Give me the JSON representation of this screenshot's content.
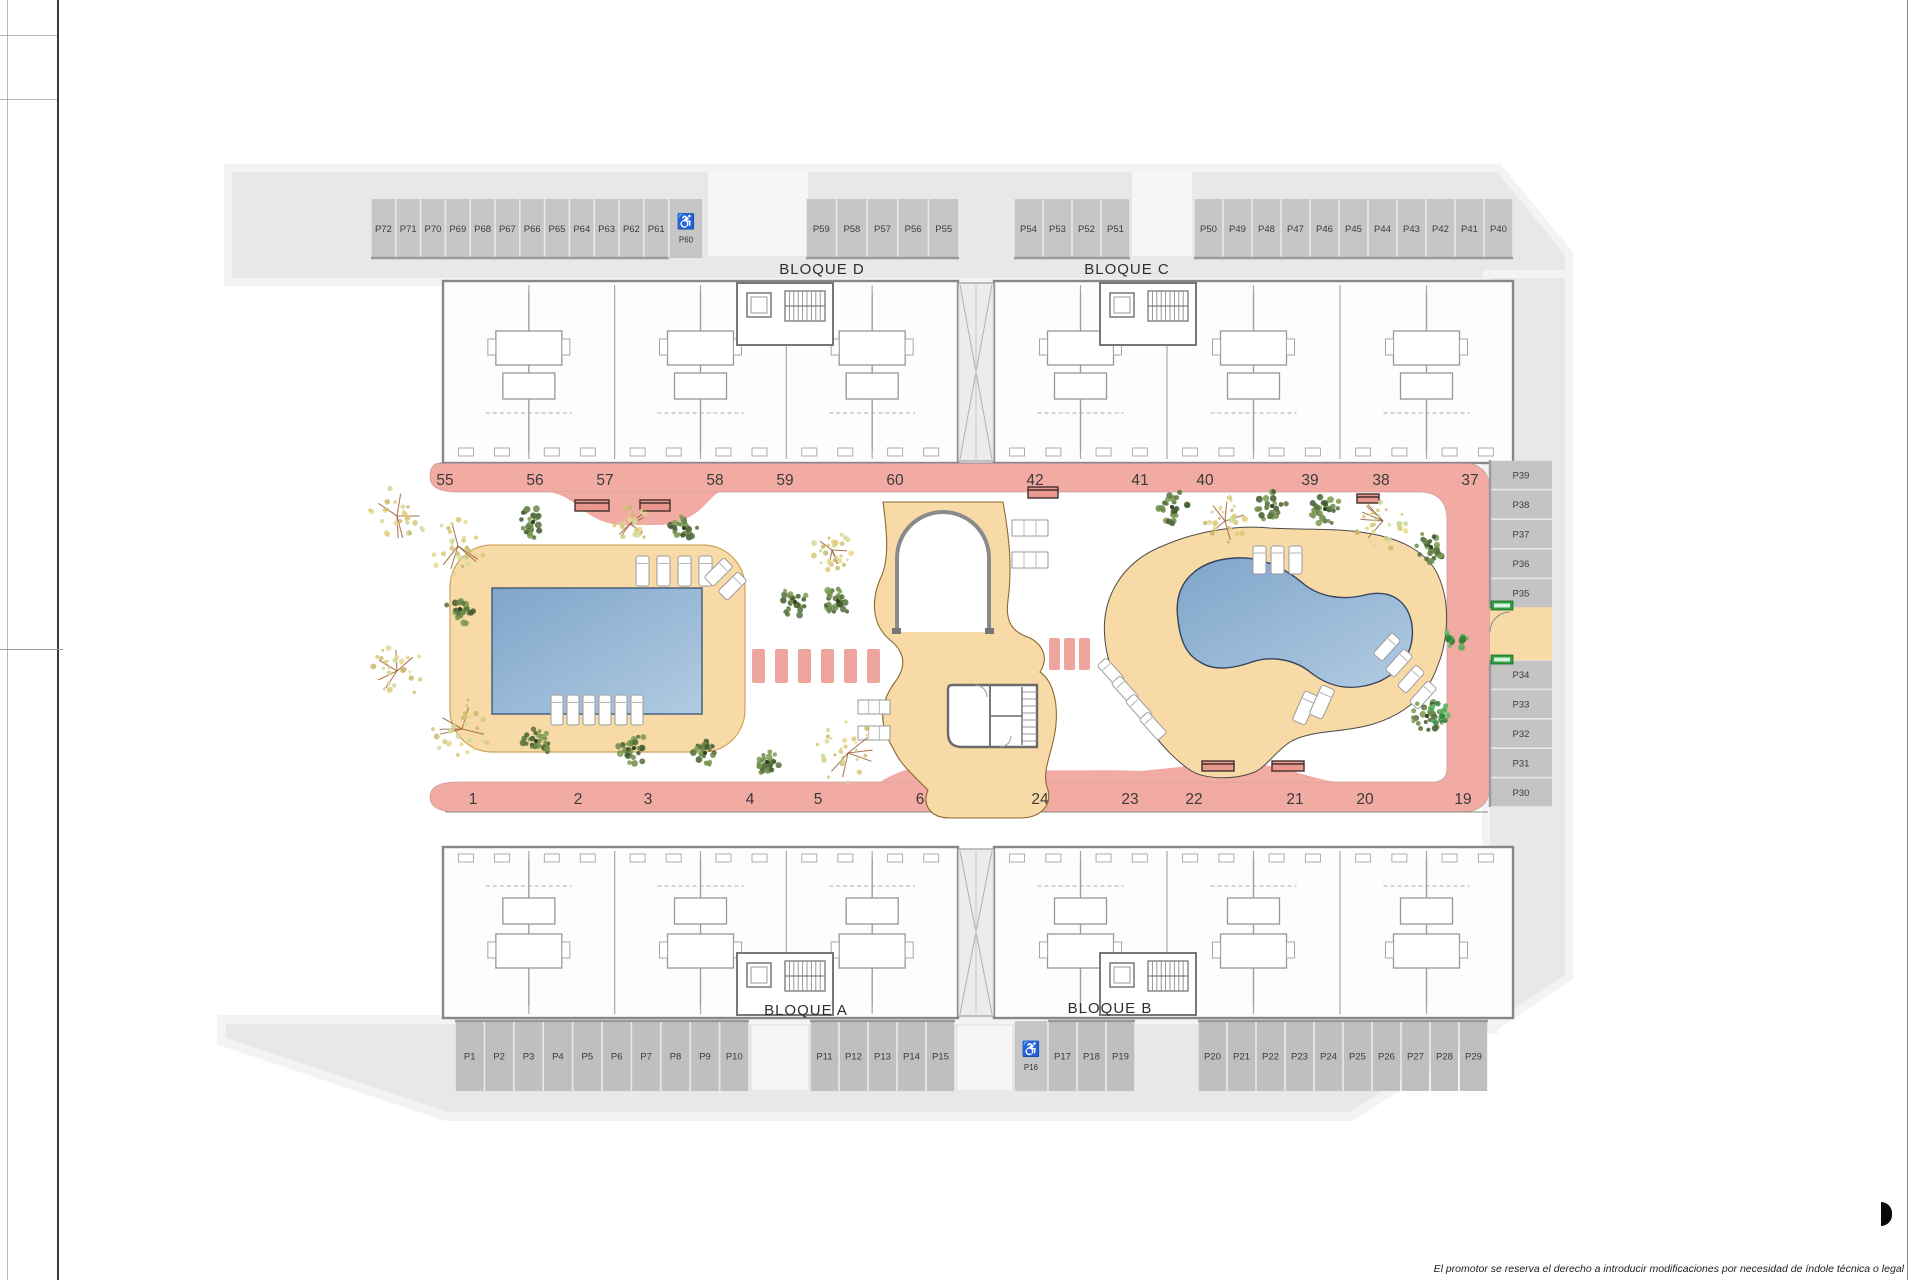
{
  "page": {
    "disclaimer": "El promotor se reserva el derecho a introducir modificaciones por necesidad de índole técnica o legal"
  },
  "blocks": {
    "a": "BLOQUE A",
    "b": "BLOQUE B",
    "c": "BLOQUE C",
    "d": "BLOQUE D"
  },
  "parking": {
    "top_left": [
      "P72",
      "P71",
      "P70",
      "P69",
      "P68",
      "P67",
      "P66",
      "P65",
      "P64",
      "P63",
      "P62",
      "P61"
    ],
    "top_left_disabled": "P60",
    "top_mid": [
      "P59",
      "P58",
      "P57",
      "P56",
      "P55"
    ],
    "top_center": [
      "P54",
      "P53",
      "P52",
      "P51"
    ],
    "top_right": [
      "P50",
      "P49",
      "P48",
      "P47",
      "P46",
      "P45",
      "P44",
      "P43",
      "P42",
      "P41",
      "P40"
    ],
    "right_upper": [
      "P39",
      "P38",
      "P37",
      "P36",
      "P35"
    ],
    "right_lower": [
      "P34",
      "P33",
      "P32",
      "P31",
      "P30"
    ],
    "bottom_left": [
      "P1",
      "P2",
      "P3",
      "P4",
      "P5",
      "P6",
      "P7",
      "P8",
      "P9",
      "P10"
    ],
    "bottom_mid": [
      "P11",
      "P12",
      "P13",
      "P14",
      "P15"
    ],
    "bottom_disabled": "P16",
    "bottom_center": [
      "P17",
      "P18",
      "P19"
    ],
    "bottom_right": [
      "P20",
      "P21",
      "P22",
      "P23",
      "P24",
      "P25",
      "P26",
      "P27",
      "P28",
      "P29"
    ]
  },
  "units": {
    "top": [
      "55",
      "56",
      "57",
      "58",
      "59",
      "60",
      "42",
      "41",
      "40",
      "39",
      "38",
      "37"
    ],
    "bottom": [
      "1",
      "2",
      "3",
      "4",
      "5",
      "6",
      "24",
      "23",
      "22",
      "21",
      "20",
      "19"
    ]
  },
  "icons": {
    "disabled_parking": "♿",
    "emergency_exit": "EXIT"
  },
  "colors": {
    "walkway_pink": "#f1aba3",
    "deck_tan": "#f8daa6",
    "pool_blue": "#88abce",
    "site_gray": "#e8e8e8",
    "stall_gray": "#c6c6c6",
    "exit_green": "#2f9e44"
  }
}
